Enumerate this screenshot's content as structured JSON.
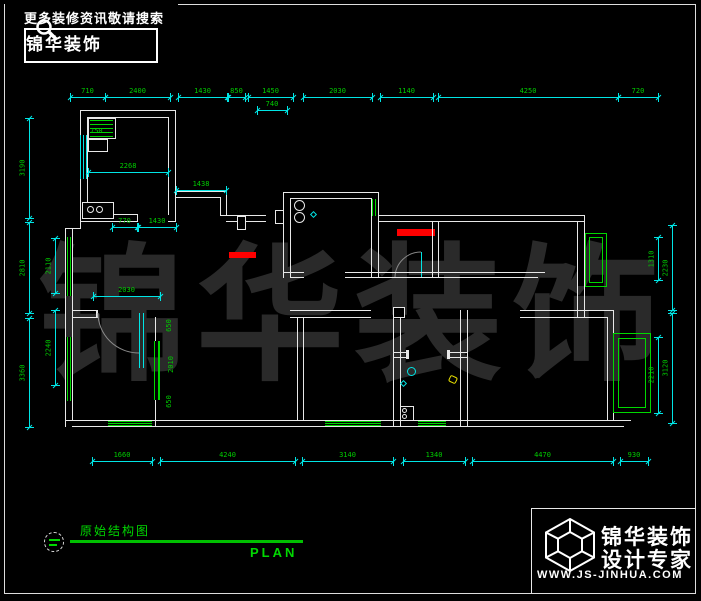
{
  "header": {
    "tagline": "更多装修资讯敬请搜索",
    "brand": "锦华装饰"
  },
  "footer": {
    "sheet_title": "原始结构图",
    "plan_label": "PLAN"
  },
  "titleblock": {
    "brand_line1": "锦华装饰",
    "brand_line2": "设计专家",
    "website": "WWW.JS-JINHUA.COM"
  },
  "watermark": {
    "text": "锦华装饰"
  },
  "colors": {
    "background": "#000000",
    "wall_white": "#e8e8e8",
    "dim_line_cyan": "#00e5e5",
    "dim_text_green": "#00cc00",
    "accent_green": "#00d800",
    "highlight_red": "#ff0000",
    "watermark_gray": "#2a2a2a"
  },
  "icons": [
    "search-icon",
    "cube-logo-icon",
    "section-marker-icon"
  ],
  "dims": {
    "h_chains": [
      {
        "y": 97,
        "segs": [
          {
            "x1": 70,
            "x2": 105,
            "v": "710"
          },
          {
            "x1": 105,
            "x2": 170,
            "v": "2400"
          },
          {
            "x1": 178,
            "x2": 227,
            "v": "1430"
          },
          {
            "x1": 228,
            "x2": 245,
            "v": "850"
          },
          {
            "x1": 248,
            "x2": 293,
            "v": "1450"
          },
          {
            "x1": 303,
            "x2": 372,
            "v": "2030"
          },
          {
            "x1": 380,
            "x2": 433,
            "v": "1140"
          },
          {
            "x1": 438,
            "x2": 618,
            "v": "4250"
          },
          {
            "x1": 618,
            "x2": 658,
            "v": "720"
          }
        ]
      },
      {
        "y": 110,
        "segs": [
          {
            "x1": 257,
            "x2": 287,
            "v": "740"
          }
        ]
      },
      {
        "y": 461,
        "segs": [
          {
            "x1": 92,
            "x2": 152,
            "v": "1660"
          },
          {
            "x1": 160,
            "x2": 295,
            "v": "4240"
          },
          {
            "x1": 302,
            "x2": 393,
            "v": "3140"
          },
          {
            "x1": 403,
            "x2": 465,
            "v": "1340"
          },
          {
            "x1": 472,
            "x2": 613,
            "v": "4470"
          },
          {
            "x1": 620,
            "x2": 648,
            "v": "930"
          }
        ]
      },
      {
        "y": 172,
        "segs": [
          {
            "x1": 88,
            "x2": 168,
            "v": "2268"
          }
        ]
      },
      {
        "y": 190,
        "segs": [
          {
            "x1": 176,
            "x2": 226,
            "v": "1438"
          }
        ]
      },
      {
        "y": 227,
        "segs": [
          {
            "x1": 112,
            "x2": 137,
            "v": "770"
          },
          {
            "x1": 138,
            "x2": 176,
            "v": "1430"
          }
        ]
      },
      {
        "y": 296,
        "segs": [
          {
            "x1": 93,
            "x2": 160,
            "v": "2030"
          }
        ]
      }
    ],
    "v_chains": [
      {
        "x": 29,
        "segs": [
          {
            "y1": 118,
            "y2": 218,
            "v": "3190"
          },
          {
            "y1": 222,
            "y2": 313,
            "v": "2810"
          },
          {
            "y1": 318,
            "y2": 427,
            "v": "3360"
          }
        ]
      },
      {
        "x": 55,
        "segs": [
          {
            "y1": 238,
            "y2": 293,
            "v": "2110"
          },
          {
            "y1": 310,
            "y2": 385,
            "v": "2240"
          }
        ]
      },
      {
        "x": 658,
        "segs": [
          {
            "y1": 237,
            "y2": 280,
            "v": "1310"
          },
          {
            "y1": 337,
            "y2": 413,
            "v": "2210"
          }
        ]
      },
      {
        "x": 672,
        "segs": [
          {
            "y1": 225,
            "y2": 310,
            "v": "2230"
          },
          {
            "y1": 313,
            "y2": 423,
            "v": "3120"
          }
        ]
      }
    ],
    "free_labels": [
      {
        "x": 90,
        "y": 128,
        "v": "750",
        "rot": 0
      },
      {
        "x": 163,
        "y": 322,
        "v": "650",
        "rot": -90
      },
      {
        "x": 163,
        "y": 361,
        "v": "2010",
        "rot": -90
      },
      {
        "x": 163,
        "y": 398,
        "v": "650",
        "rot": -90
      }
    ]
  }
}
